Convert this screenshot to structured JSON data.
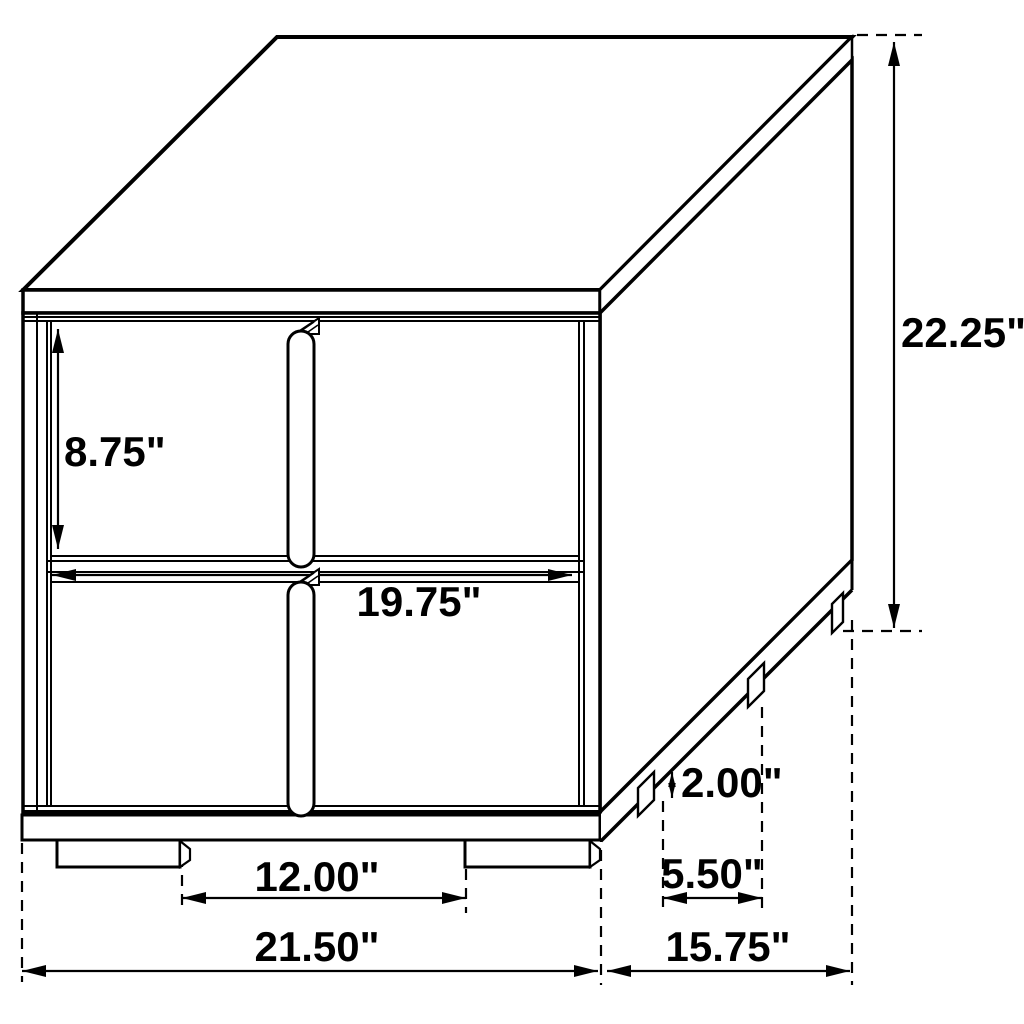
{
  "diagram": {
    "subject": "two-drawer nightstand technical dimension drawing",
    "view": "isometric line drawing",
    "background_color": "#ffffff",
    "line_color": "#000000",
    "text_color": "#000000",
    "unit": "inches"
  },
  "dimensions": {
    "overall_height": {
      "label": "22.25\"",
      "inches": 22.25,
      "measures": "overall height"
    },
    "drawer_height": {
      "label": "8.75\"",
      "inches": 8.75,
      "measures": "drawer face height"
    },
    "drawer_width": {
      "label": "19.75\"",
      "inches": 19.75,
      "measures": "drawer face width"
    },
    "leg_height": {
      "label": "2.00\"",
      "inches": 2.0,
      "measures": "leg height"
    },
    "side_leg_spacing": {
      "label": "5.50\"",
      "inches": 5.5,
      "measures": "side leg spacing"
    },
    "front_leg_spacing": {
      "label": "12.00\"",
      "inches": 12.0,
      "measures": "front leg spacing"
    },
    "overall_width": {
      "label": "21.50\"",
      "inches": 21.5,
      "measures": "overall width"
    },
    "overall_depth": {
      "label": "15.75\"",
      "inches": 15.75,
      "measures": "overall depth"
    }
  }
}
